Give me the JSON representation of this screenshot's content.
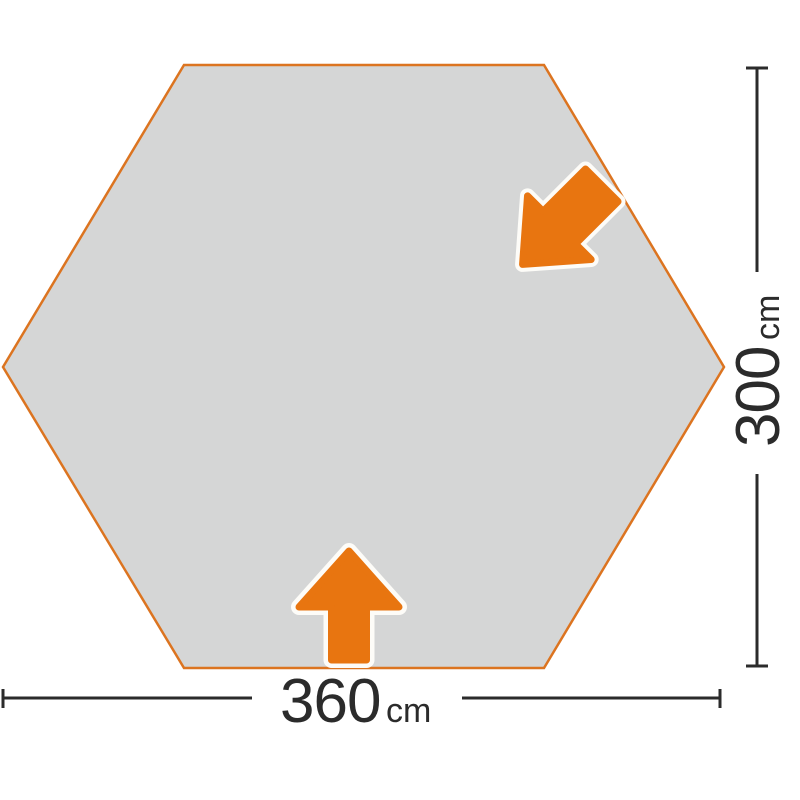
{
  "diagram": {
    "title": "hexagonal tent footprint dimension diagram",
    "shape": "hexagon",
    "width_label": {
      "value": "360",
      "unit": "cm"
    },
    "height_label": {
      "value": "300",
      "unit": "cm"
    },
    "icons": {
      "bottom_arrow": "entrance-arrow-up",
      "upper_right_arrow": "entrance-arrow-down-left"
    }
  },
  "colors": {
    "background": "#FFFFFF",
    "shape_fill": "#D5D6D6",
    "shape_border": "#DC7420",
    "arrow_fill": "#E87510",
    "arrow_outline": "#FDFCF8",
    "dimension_line": "#2B2B2B",
    "label_text": "#2B2B2B"
  }
}
